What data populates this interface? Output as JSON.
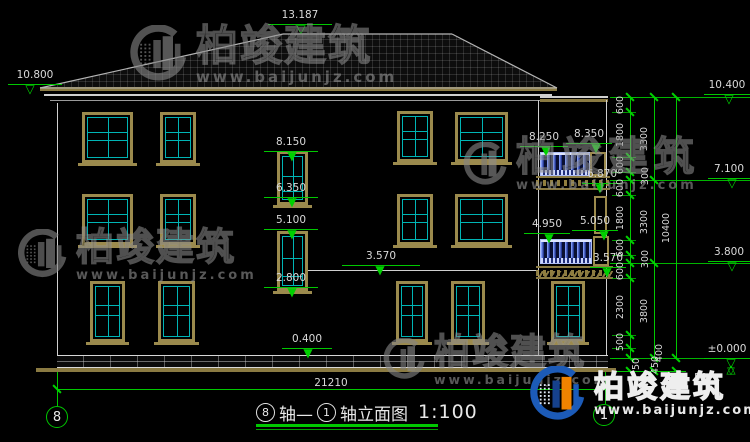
{
  "watermark": {
    "brand": "柏竣建筑",
    "website": "www.baijunjz.com"
  },
  "footer_logo": {
    "brand": "柏竣建筑",
    "website": "www.baijunjz.com"
  },
  "title_block": {
    "axis_from": "8",
    "mid": "轴—",
    "axis_to": "1",
    "tail": "轴立面图",
    "scale": "1:100"
  },
  "axis_bubbles": {
    "left": "8",
    "right": "1"
  },
  "bottom_dim": {
    "label": "21210"
  },
  "elevation_markers": [
    {
      "id": "ridge",
      "label": "13.187",
      "lx": 268,
      "lw": 64,
      "ly": 24,
      "tx": 301,
      "open": true
    },
    {
      "id": "left-eave",
      "label": "10.800",
      "lx": 8,
      "lw": 54,
      "ly": 84,
      "tx": 30,
      "open": true
    },
    {
      "id": "right-parapet",
      "label": "10.400",
      "lx": 704,
      "lw": 46,
      "ly": 94,
      "tx": 729,
      "open": true
    },
    {
      "id": "stair-win3-top",
      "label": "8.150",
      "lx": 264,
      "lw": 54,
      "ly": 151,
      "tx": 292,
      "open": false
    },
    {
      "id": "balc3-floor",
      "label": "8.250",
      "lx": 520,
      "lw": 48,
      "ly": 146,
      "tx": 546,
      "open": false
    },
    {
      "id": "balc3-rail",
      "label": "8.350",
      "lx": 566,
      "lw": 46,
      "ly": 143,
      "tx": 596,
      "open": false
    },
    {
      "id": "level-7100",
      "label": "7.100",
      "lx": 708,
      "lw": 42,
      "ly": 178,
      "tx": 732,
      "open": true
    },
    {
      "id": "balc3-slab",
      "label": "6.870",
      "lx": 582,
      "lw": 40,
      "ly": 183,
      "tx": 600,
      "open": false
    },
    {
      "id": "stair-win3-sill",
      "label": "6.350",
      "lx": 264,
      "lw": 54,
      "ly": 197,
      "tx": 292,
      "open": false
    },
    {
      "id": "stair-win2-top",
      "label": "5.100",
      "lx": 264,
      "lw": 54,
      "ly": 229,
      "tx": 292,
      "open": false
    },
    {
      "id": "balc2-floor",
      "label": "4.950",
      "lx": 524,
      "lw": 46,
      "ly": 233,
      "tx": 549,
      "open": false
    },
    {
      "id": "balc2-rail",
      "label": "5.050",
      "lx": 572,
      "lw": 46,
      "ly": 230,
      "tx": 604,
      "open": false
    },
    {
      "id": "level-3800",
      "label": "3.800",
      "lx": 708,
      "lw": 42,
      "ly": 261,
      "tx": 732,
      "open": true
    },
    {
      "id": "floor2-mid",
      "label": "3.570",
      "lx": 342,
      "lw": 78,
      "ly": 265,
      "tx": 380,
      "open": false
    },
    {
      "id": "balc2-slab",
      "label": "3.570",
      "lx": 590,
      "lw": 36,
      "ly": 267,
      "tx": 607,
      "open": false
    },
    {
      "id": "stair-win2-sill",
      "label": "2.800",
      "lx": 264,
      "lw": 54,
      "ly": 287,
      "tx": 292,
      "open": false
    },
    {
      "id": "plinth-top",
      "label": "0.400",
      "lx": 282,
      "lw": 50,
      "ly": 348,
      "tx": 308,
      "open": false
    },
    {
      "id": "ground",
      "label": "±0.000",
      "lx": 704,
      "lw": 46,
      "ly": 358,
      "tx": 731,
      "open": true,
      "pm": true
    }
  ],
  "right_chain": {
    "divisions": [
      97,
      112,
      157,
      172,
      180,
      195,
      240,
      255,
      263,
      278,
      335,
      348,
      358
    ],
    "inner": [
      "600",
      "1800",
      "600",
      "300",
      "600",
      "1800",
      "600",
      "300",
      "600",
      "2300",
      "500",
      "400"
    ],
    "inner_offset_idx": [
      3,
      7,
      11
    ],
    "mid_divisions": [
      97,
      180,
      263,
      358
    ],
    "middle": [
      "3300",
      "3300",
      "3800"
    ],
    "total": "10400",
    "extras": [
      "50",
      "450",
      "50"
    ]
  },
  "drawing": {
    "windows": [
      {
        "x": 82,
        "y": 112,
        "w": 51,
        "h": 51,
        "t": "std"
      },
      {
        "x": 160,
        "y": 112,
        "w": 36,
        "h": 51,
        "t": "std"
      },
      {
        "x": 397,
        "y": 111,
        "w": 36,
        "h": 51,
        "t": "std"
      },
      {
        "x": 455,
        "y": 112,
        "w": 53,
        "h": 50,
        "t": "std"
      },
      {
        "x": 82,
        "y": 194,
        "w": 51,
        "h": 51,
        "t": "std"
      },
      {
        "x": 160,
        "y": 194,
        "w": 36,
        "h": 51,
        "t": "std"
      },
      {
        "x": 397,
        "y": 194,
        "w": 36,
        "h": 51,
        "t": "std"
      },
      {
        "x": 455,
        "y": 194,
        "w": 53,
        "h": 51,
        "t": "std"
      },
      {
        "x": 90,
        "y": 281,
        "w": 35,
        "h": 61,
        "t": "std"
      },
      {
        "x": 158,
        "y": 281,
        "w": 37,
        "h": 61,
        "t": "std"
      },
      {
        "x": 396,
        "y": 281,
        "w": 32,
        "h": 61,
        "t": "std"
      },
      {
        "x": 451,
        "y": 281,
        "w": 34,
        "h": 61,
        "t": "std"
      },
      {
        "x": 551,
        "y": 281,
        "w": 34,
        "h": 61,
        "t": "std"
      },
      {
        "x": 277,
        "y": 151,
        "w": 31,
        "h": 54,
        "t": "mid"
      },
      {
        "x": 277,
        "y": 231,
        "w": 31,
        "h": 60,
        "t": "mid"
      },
      {
        "x": 594,
        "y": 196,
        "w": 13,
        "h": 38,
        "t": "bay"
      },
      {
        "x": 593,
        "y": 236,
        "w": 16,
        "h": 30,
        "t": "bay"
      }
    ]
  },
  "colors": {
    "dim_green": "#00c800",
    "glazing_cyan": "#00b4b4",
    "frame_tan": "#9b8a4d",
    "rail_blue": "#22307a",
    "logo_blue": "#1c5bb8",
    "logo_orange": "#f08300"
  }
}
